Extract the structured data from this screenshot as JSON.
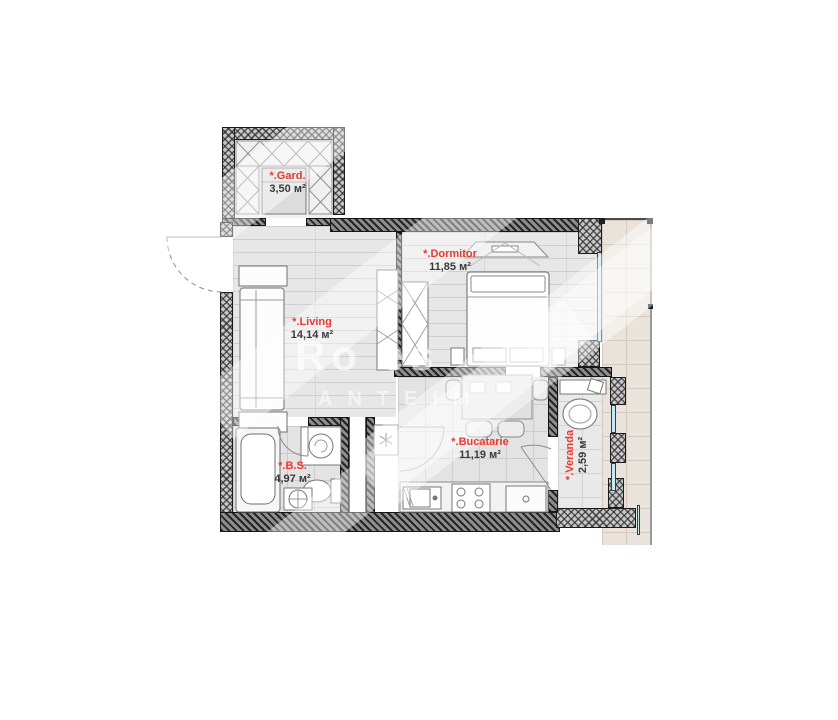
{
  "plan": {
    "rooms": [
      {
        "id": "gard",
        "label": "*.Gard.",
        "area": "3,50 м²"
      },
      {
        "id": "dormitor",
        "label": "*.Dormitor",
        "area": "11,85 м²"
      },
      {
        "id": "living",
        "label": "*.Living",
        "area": "14,14 м²"
      },
      {
        "id": "bucatarie",
        "label": "*.Bucatarie",
        "area": "11,19 м²"
      },
      {
        "id": "bs",
        "label": "*.B.S.",
        "area": "4,97 м²"
      },
      {
        "id": "veranda",
        "label": "*.Veranda",
        "area": "2,59 м²"
      }
    ],
    "watermark": {
      "line1": "Ro es",
      "line2": "ANTEIM"
    },
    "colors": {
      "room_label_red": "#e8392e",
      "area_text": "#3a3a3a",
      "wall_dark": "#3f3f3f",
      "window_blue": "#c3e9f2",
      "balcony_floor": "#eae3db"
    }
  }
}
